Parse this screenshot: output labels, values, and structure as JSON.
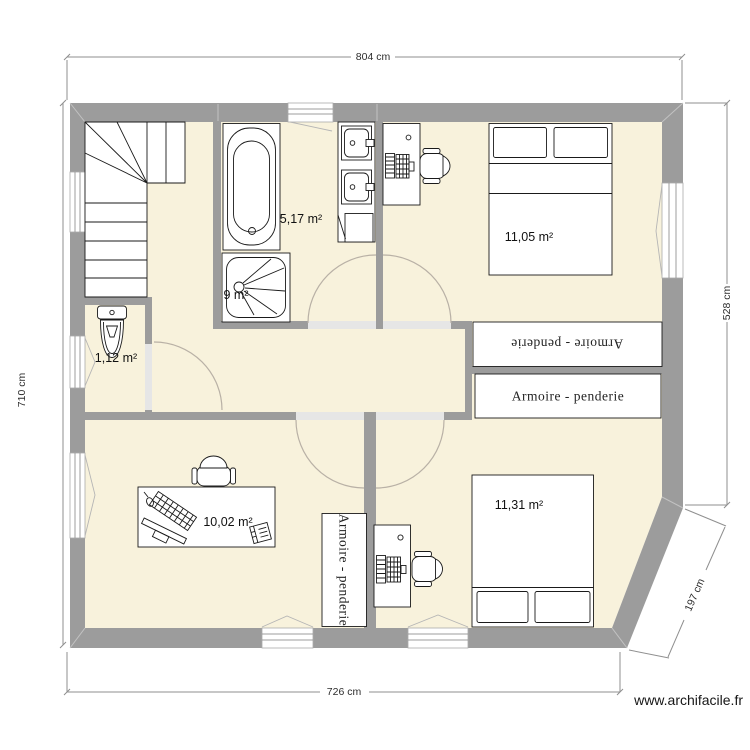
{
  "plan": {
    "watermark": "www.archifacile.fr",
    "unit": "cm",
    "dimensions": {
      "top": "804 cm",
      "left": "710 cm",
      "right": "528 cm",
      "bottom": "726 cm",
      "bevel": "197 cm"
    },
    "rooms": [
      {
        "name": "bathroom",
        "area_label": "5,17 m²"
      },
      {
        "name": "hall",
        "area_label": "9 m²"
      },
      {
        "name": "wc",
        "area_label": "1,12 m²"
      },
      {
        "name": "bedroom-top",
        "area_label": "11,05 m²"
      },
      {
        "name": "office",
        "area_label": "10,02 m²"
      },
      {
        "name": "bedroom-bottom",
        "area_label": "11,31 m²"
      }
    ],
    "furniture": {
      "wardrobe_label": "Armoire - penderie"
    },
    "colors": {
      "floor": "#f8f2dc",
      "wall": "#9c9c9c",
      "threshold": "#e6e6e6",
      "door_arc": "#b9b1a6",
      "outline": "#1a1a1a",
      "dim": "#8f8f8f"
    }
  }
}
